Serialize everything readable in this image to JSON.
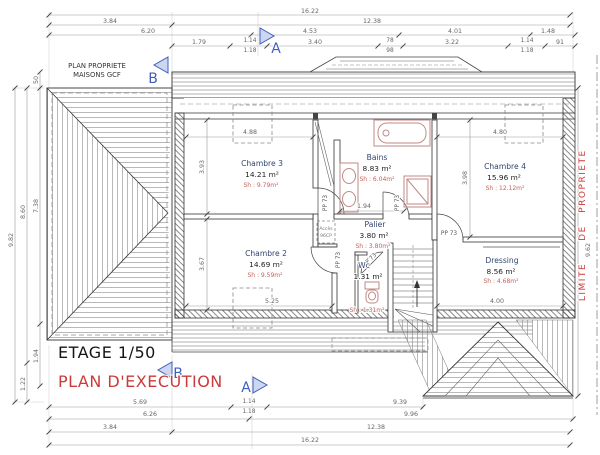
{
  "title_block": {
    "etage": "ETAGE 1/50",
    "plan": "PLAN D'EXECUTION"
  },
  "notes": {
    "property_line1": "PLAN PROPRIETE",
    "property_line2": "MAISONS GCF",
    "access_line1": "Accès",
    "access_line2": "96CP"
  },
  "boundary": {
    "word1": "LIMITE",
    "word2": "DE",
    "word3": "PROPRIETE"
  },
  "markers": {
    "a": "A",
    "b": "B"
  },
  "doors": {
    "label": "PP 73"
  },
  "rooms": [
    {
      "name": "Chambre 3",
      "area": "14.21 m²",
      "sh": "Sh : 9.79m²"
    },
    {
      "name": "Bains",
      "area": "8.83 m²",
      "sh": "Sh : 6.04m²"
    },
    {
      "name": "Chambre 4",
      "area": "15.96 m²",
      "sh": "Sh : 12.12m²"
    },
    {
      "name": "Chambre 2",
      "area": "14.69 m²",
      "sh": "Sh : 9.59m²"
    },
    {
      "name": "Palier",
      "area": "3.80 m²",
      "sh": "Sh : 3.80m²"
    },
    {
      "name": "Wc",
      "area": "1.31 m²",
      "sh": "Sh : 1.31m²"
    },
    {
      "name": "Dressing",
      "area": "8.56 m²",
      "sh": "Sh : 4.68m²"
    }
  ],
  "dims": {
    "top": {
      "total": "16.22",
      "roof": "3.84",
      "building": "12.38",
      "r3a": "6.20",
      "r3b": "4.53",
      "r3c": "4.01",
      "r3d": "1.48",
      "r4a": "1.79",
      "r4b1": "1.14",
      "r4b2": "1.18",
      "r4c": "3.40",
      "r4d1": "78",
      "r4d2": "98",
      "r4e": "3.22",
      "r4f1": "1.14",
      "r4f2": "1.18",
      "r4g": "91"
    },
    "bottom": {
      "b1a": "5.69",
      "b1b1": "1.14",
      "b1b2": "1.18",
      "b1c": "9.39",
      "b2a": "6.26",
      "b2b": "9.96",
      "b3a": "3.84",
      "b3b": "12.38",
      "b4": "16.22"
    },
    "left": {
      "eave": "50",
      "total": "9.82",
      "mid": "8.60",
      "inner": "7.38",
      "low1": "1.94",
      "low2": "1.22"
    },
    "right": {
      "total": "9.62"
    },
    "interior": {
      "ch3_w": "4.88",
      "ch3_h": "3.93",
      "ch4_w": "4.80",
      "ch4_h": "3.98",
      "bains_w": "1.94",
      "ch2_w": "5.25",
      "ch2_h": "3.67",
      "dressing_w": "4.00"
    }
  },
  "colors": {
    "accent_red": "#cc3b3b",
    "sh_red": "#c4605a",
    "fixture_pink": "#c08a8a",
    "marker_blue": "#3f5fc0",
    "room_blue": "#31456e",
    "line_dark": "#333333",
    "dim_gray": "#666666"
  }
}
